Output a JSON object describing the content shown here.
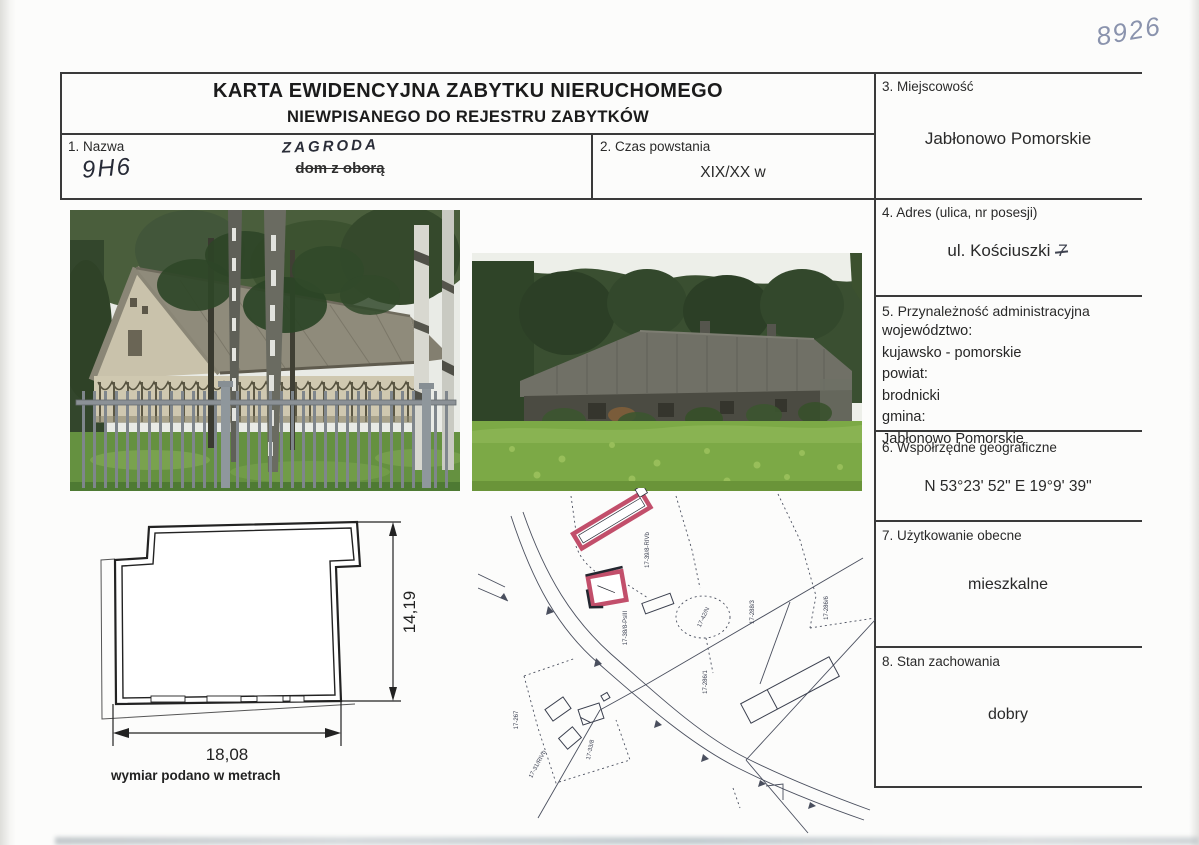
{
  "page": {
    "handwritten_corner_number": "8926"
  },
  "header": {
    "title_line1": "KARTA EWIDENCYJNA ZABYTKU NIERUCHOMEGO",
    "title_line2": "NIEWPISANEGO DO REJESTRU ZABYTKÓW"
  },
  "fields": {
    "f1": {
      "label": "1. Nazwa",
      "handwritten_code": "9H6",
      "handwritten_name": "ZAGRODA",
      "crossed_out_name": "dom z oborą"
    },
    "f2": {
      "label": "2. Czas powstania",
      "value": "XIX/XX w"
    },
    "f3": {
      "label": "3. Miejscowość",
      "value": "Jabłonowo Pomorskie"
    },
    "f4": {
      "label": "4. Adres (ulica, nr posesji)",
      "value": "ul. Kościuszki",
      "handwritten_number": "7"
    },
    "f5": {
      "label": "5. Przynależność administracyjna",
      "lines": [
        "województwo:",
        "kujawsko - pomorskie",
        "powiat:",
        "brodnicki",
        "gmina:",
        "Jabłonowo Pomorskie"
      ]
    },
    "f6": {
      "label": "6. Współrzędne geograficzne",
      "value": "N 53°23' 52\" E 19°9' 39\""
    },
    "f7": {
      "label": "7. Użytkowanie obecne",
      "value": "mieszkalne"
    },
    "f8": {
      "label": "8. Stan zachowania",
      "value": "dobry"
    }
  },
  "floor_plan": {
    "height_dim": "14,19",
    "width_dim": "18,08",
    "caption": "wymiar podano w metrach"
  },
  "site_map": {
    "labels": [
      "17-39/8-RIVb",
      "17-38/8-PsIII",
      "17-42/N",
      "17-288/3",
      "17-286/6",
      "17-286/1",
      "17-267",
      "17-31/RIVb",
      "17-33/8"
    ]
  },
  "colors": {
    "map_highlight_red": "#c24f6b",
    "handwriting_ink": "#262a36",
    "pencil_blue": "#8a93ad",
    "table_line": "#3a3a3a"
  }
}
